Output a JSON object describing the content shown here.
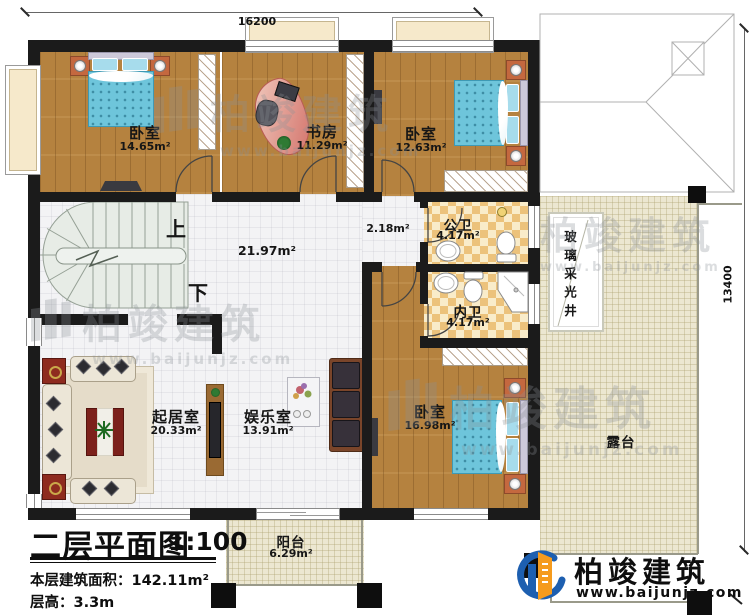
{
  "palette": {
    "wall": "#1b1b1b",
    "wood_floor": "#b5823f",
    "tile_floor": "#f3f3f5",
    "terrace_floor": "#ece7d1",
    "checker_dark": "#ecc27b",
    "checker_light": "#f9ecca",
    "stairs": "#e6ebe5",
    "bed_blue": "#6ec5db",
    "accent_red": "#8e2b1f",
    "logo_blue": "#1d5fb0",
    "logo_orange": "#f59b1e"
  },
  "dimensions": {
    "top_width": "16200",
    "right_height": "13400"
  },
  "stairs": {
    "up_label": "上",
    "down_label": "下"
  },
  "rooms": {
    "bedroom1": {
      "name": "卧室",
      "area": "14.65m²"
    },
    "study": {
      "name": "书房",
      "area": "11.29m²"
    },
    "bedroom2": {
      "name": "卧室",
      "area": "12.63m²"
    },
    "hall": {
      "area": "21.97m²"
    },
    "hallway2": {
      "area": "2.18m²"
    },
    "public_bath": {
      "name": "公卫",
      "area": "4.17m²"
    },
    "private_bath": {
      "name": "内卫",
      "area": "4.17m²"
    },
    "master_bedroom": {
      "name": "卧室",
      "area": "16.98m²"
    },
    "living": {
      "name": "起居室",
      "area": "20.33m²"
    },
    "entertainment": {
      "name": "娱乐室",
      "area": "13.91m²"
    },
    "balcony": {
      "name": "阳台",
      "area": "6.29m²"
    },
    "terrace": {
      "name": "露台"
    },
    "lightwell": {
      "name": "玻璃采光井"
    }
  },
  "titleblock": {
    "title": "二层平面图",
    "scale": "1:100",
    "floor_area_label": "本层建筑面积：",
    "floor_area_value": "142.11m²",
    "floor_height_label": "层高：",
    "floor_height_value": "3.3m"
  },
  "brand": {
    "name": "柏竣建筑",
    "website": "www.baijunjz.com"
  }
}
